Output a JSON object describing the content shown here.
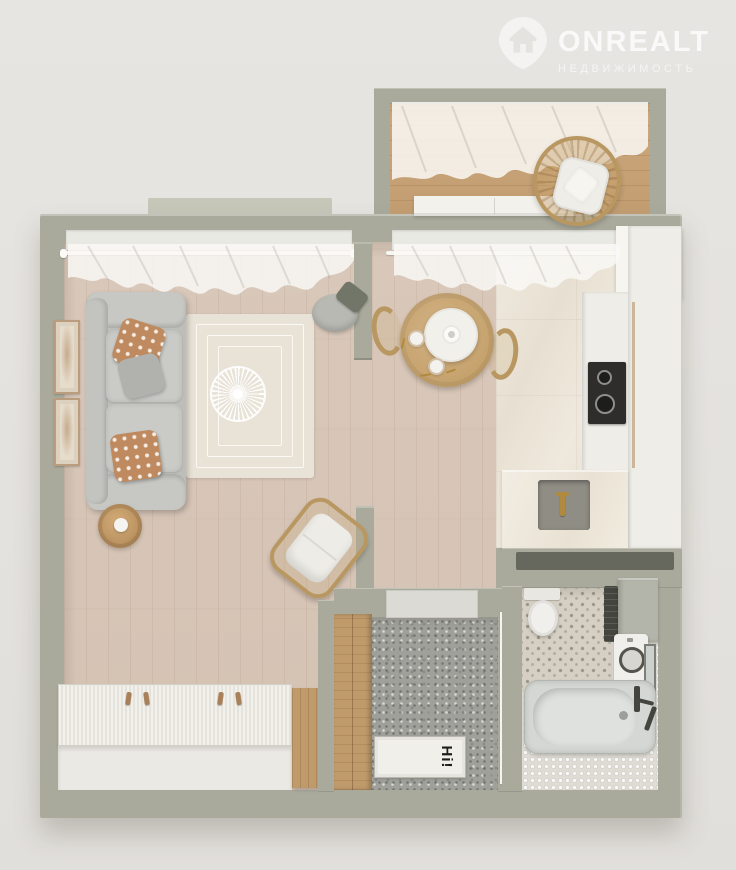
{
  "watermark": {
    "brand": "ONREALT",
    "subtitle": "НЕДВИЖИМОСТЬ",
    "icon": "house-pin-icon"
  },
  "entry": {
    "doormat_text": "Hi!"
  },
  "colors": {
    "wall": "#a9aa9c",
    "wall_light": "#c6c7b9",
    "wood": "#d9c8ba",
    "balcony_wood": "#cda87c",
    "marble": "#ebe5da",
    "terrazzo": "#9fa09a",
    "penny": "#dfdcd5",
    "pattern_tile": "#d6d0c4",
    "white_furniture": "#f3f1ec",
    "cabinet_white": "#efede8",
    "sofa": "#bdbeba",
    "pillow_tan": "#bf8a5f",
    "pillow_grey": "#b1b2ae",
    "rug": "#e9e3d7",
    "rattan": "#b99761",
    "table_wood": "#c5a26c",
    "wardrobe_wood": "#bf9a6b",
    "cooktop": "#2e2d2b",
    "tub": "#d4d7d3",
    "dark_fixture": "#45453f",
    "gold": "#b08a3e",
    "door_white": "#f6f4f0"
  }
}
